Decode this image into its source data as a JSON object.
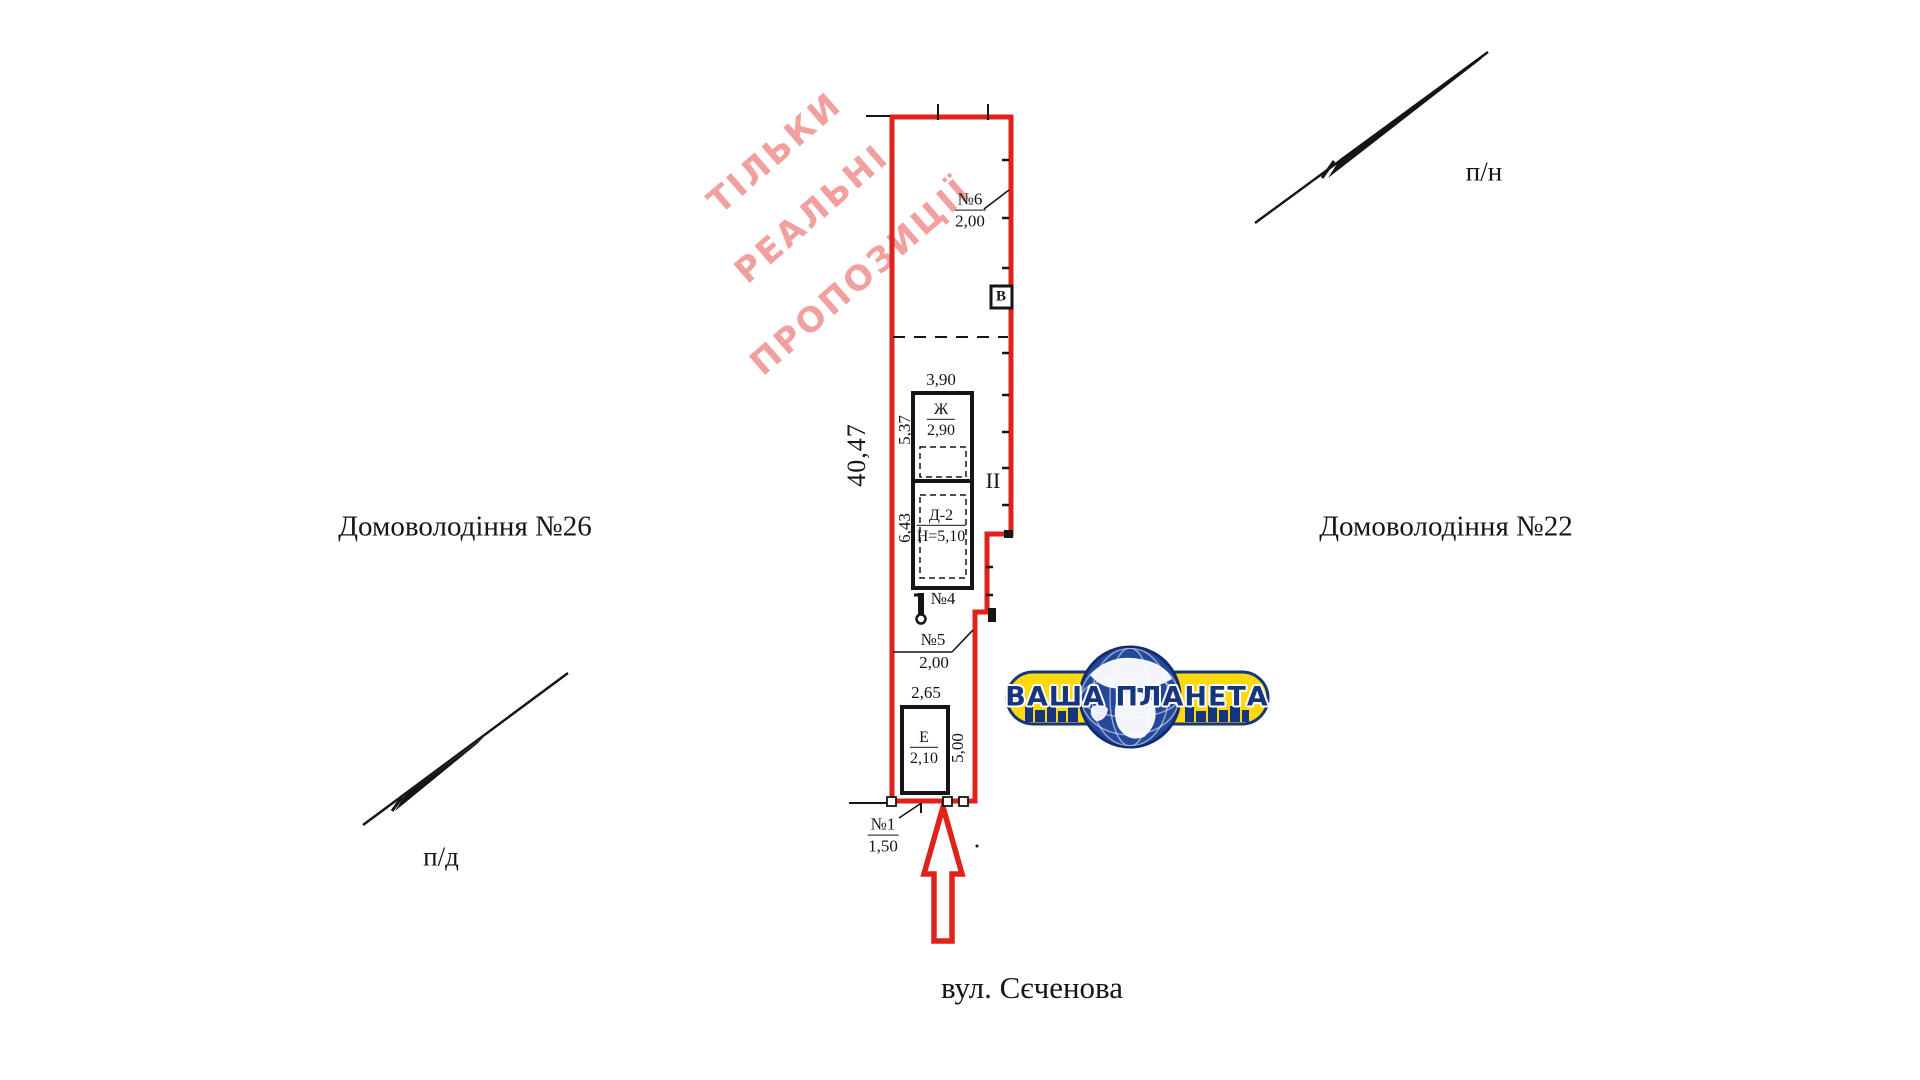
{
  "watermark": {
    "lines": [
      "ТІЛЬКИ",
      "РЕАЛЬНІ",
      "ПРОПОЗИЦІЇ"
    ]
  },
  "neighbors": {
    "left": "Домоволодіння №26",
    "right": "Домоволодіння №22"
  },
  "street": "вул. Сєченова",
  "compass": {
    "north": "п/н",
    "south": "п/д"
  },
  "plot": {
    "overall_length": "40,47",
    "section_label": "II",
    "well_label": "В",
    "dims": {
      "d537": "5,37",
      "d643": "6,43",
      "d390": "3,90",
      "d265": "2,65",
      "d500": "5,00"
    },
    "points": {
      "p6": {
        "label": "№6",
        "value": "2,00"
      },
      "p5": {
        "label": "№5",
        "value": "2,00"
      },
      "p4": {
        "label": "№4"
      },
      "p1": {
        "label": "№1",
        "value": "1,50"
      }
    },
    "buildings": {
      "zh": {
        "label": "Ж",
        "value": "2,90"
      },
      "d2": {
        "label": "Д-2",
        "value": "Н=5,10"
      },
      "e": {
        "label": "Е",
        "value": "2,10"
      }
    }
  },
  "logo": {
    "name": "ВАША ПЛАНЕТА"
  },
  "colors": {
    "outline_red": "#df221a",
    "watermark_pink": "#f29f9f",
    "logo_yellow": "#ffd90c",
    "logo_blue": "#17357f"
  }
}
